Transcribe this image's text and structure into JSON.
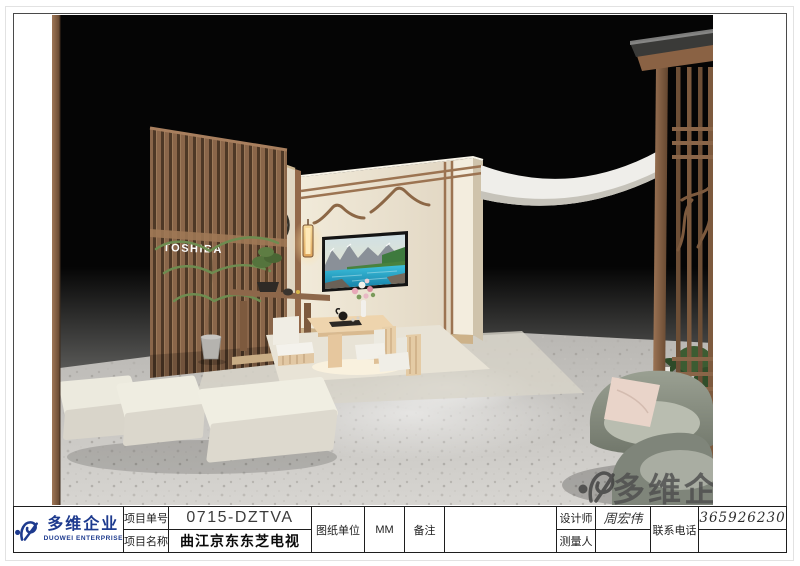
{
  "render": {
    "toshiba_sign": "TOSHIBA",
    "watermark_text": "多维企业"
  },
  "logo": {
    "name": "多维企业",
    "subtitle": "DUOWEI ENTERPRISE"
  },
  "title_block": {
    "project_no_label": "项目单号",
    "project_no_value": "0715-DZTVA",
    "project_name_label": "项目名称",
    "project_name_value": "曲江京东东芝电视",
    "drawing_unit_label": "图纸单位",
    "drawing_unit_value": "MM",
    "remarks_label": "备注",
    "remarks_value": "",
    "designer_label": "设计师",
    "designer_value": "周宏伟",
    "surveyor_label": "测量人",
    "surveyor_value": "",
    "phone_label": "联系电话",
    "phone_value": "13659262305"
  },
  "colors": {
    "logo_blue": "#1d3a8e",
    "wood_brown": "#8a664a",
    "wall_cream": "#ece4d4",
    "watermark_gray": "#4c4c4c"
  }
}
